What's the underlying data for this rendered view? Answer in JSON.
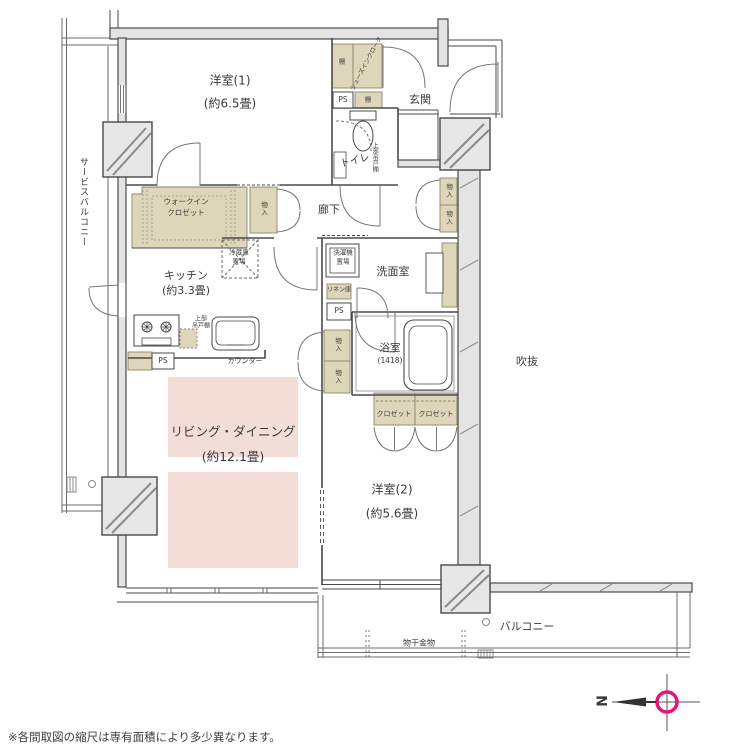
{
  "colors": {
    "storage_fill": "#ddd6ba",
    "ld_highlight": "#f3ded7",
    "wall_fill": "#e4e4e4",
    "line": "#4a4a4a",
    "compass_accent": "#e8127c",
    "text": "#333333"
  },
  "note": "※各間取図の縮尺は専有面積により多少異なります。",
  "compass": {
    "north_label": "N"
  },
  "rooms": {
    "western1": {
      "name": "洋室(1)",
      "size": "(約6.5畳)"
    },
    "entrance": {
      "name": "玄関"
    },
    "toilet": {
      "name": "トイレ"
    },
    "hallway": {
      "name": "廊下"
    },
    "kitchen": {
      "name": "キッチン",
      "size": "(約3.3畳)"
    },
    "washroom": {
      "name": "洗面室"
    },
    "bathroom": {
      "name": "浴室",
      "size": "(1418)"
    },
    "living_dining": {
      "name": "リビング・ダイニング",
      "size": "(約12.1畳)"
    },
    "western2": {
      "name": "洋室(2)",
      "size": "(約5.6畳)"
    },
    "balcony": {
      "name": "バルコニー"
    },
    "service_balcony": {
      "name": "サービスバルコニー"
    },
    "void_space": {
      "name": "吹抜"
    }
  },
  "storage": {
    "shoes_in_closet": "シューズインクローク",
    "shelf": "棚",
    "walk_in_closet": {
      "line1": "ウォークイン",
      "line2": "クロゼット"
    },
    "storage_compartment": "物入",
    "closet": "クロゼット",
    "linen_cabinet": "リネン庫",
    "upper_cabinet": "上部吊戸棚",
    "upper_cabinet_kitchen": {
      "line1": "上部",
      "line2": "吊戸棚"
    }
  },
  "fixtures": {
    "pipe_space": "PS",
    "refrigerator_space": {
      "line1": "冷蔵庫",
      "line2": "置場"
    },
    "washer_space": {
      "line1": "洗濯機",
      "line2": "置場"
    },
    "counter": "カウンター",
    "laundry_hardware": "物干金物"
  }
}
